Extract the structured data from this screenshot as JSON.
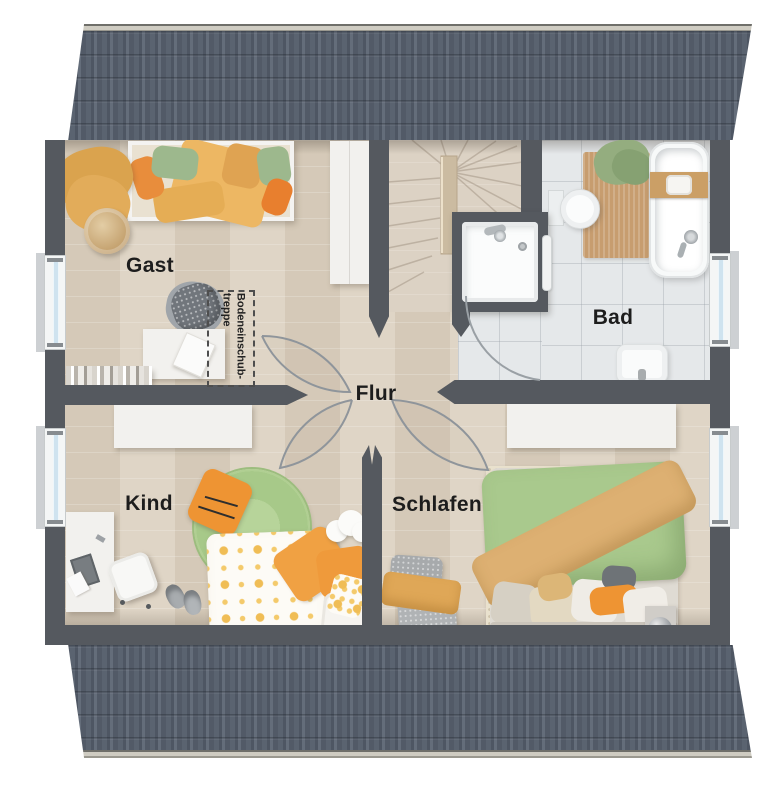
{
  "plan": {
    "rooms": {
      "gast": {
        "label": "Gast"
      },
      "bad": {
        "label": "Bad"
      },
      "flur": {
        "label": "Flur"
      },
      "kind": {
        "label": "Kind"
      },
      "schlafen": {
        "label": "Schlafen"
      }
    },
    "annotations": {
      "attic_stairs": {
        "line1": "Bodeneinschub-",
        "line2": "treppe"
      }
    },
    "colors": {
      "roof": "#59626f",
      "wall": "#55595f",
      "wood_floor": "#dcd1c0",
      "tile_floor": "#e5e8ea",
      "accent_orange": "#ee9433",
      "accent_green": "#a9c98d",
      "accent_yellow": "#eaba62"
    }
  }
}
